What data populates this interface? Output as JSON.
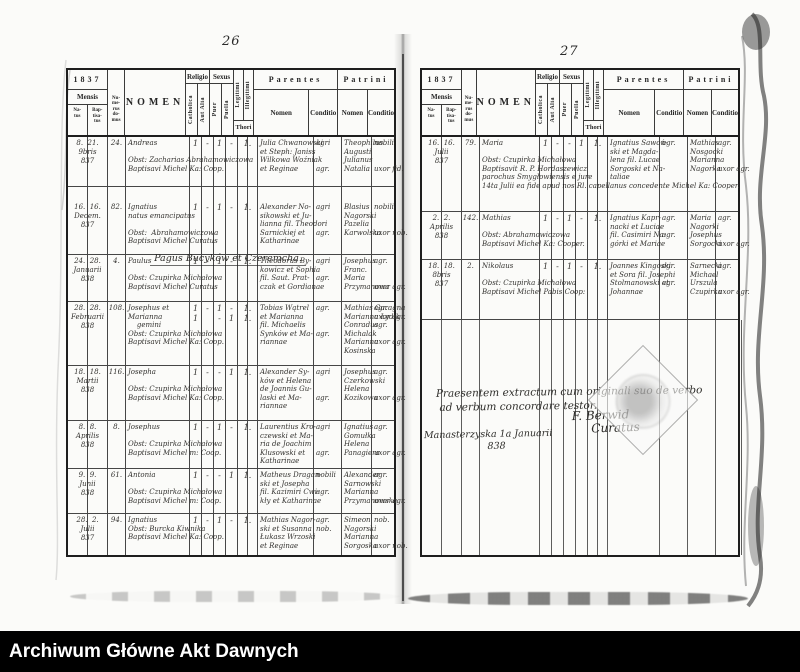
{
  "colors": {
    "paper": "#fbfbf9",
    "ink": "#262626",
    "bar_bg": "#000000",
    "bar_fg": "#ffffff"
  },
  "archive_bar": {
    "label": "Archiwum Główne Akt Dawnych"
  },
  "column_headers": {
    "year": "1837",
    "mensis": "Mensis",
    "natus": "Na-\ntus",
    "baptisatus": "Bap-\ntisa-\ntus",
    "numerus_domus": "Nu-\nme-\nrus\ndo-\nmus",
    "nomen": "NOMEN",
    "religio": "Religio",
    "catholica": "Catholica",
    "aut_alia": "Aut Alia",
    "sexus": "Sexus",
    "puer": "Puer",
    "puella": "Puella",
    "legitimi": "Legitimi",
    "illegitimi": "Illegitimi",
    "thori": "Thori",
    "parentes": "Parentes",
    "patrini": "Patrini",
    "parentes_nomen": "Nomen",
    "parentes_conditio": "Conditio",
    "patrini_nomen": "Nomen",
    "patrini_conditio": "Conditio"
  },
  "left_page": {
    "page_number": "26",
    "section_header": "Pagus Bucyków et Czeremcha.",
    "rows": [
      {
        "date": "8.  21.\n9bris\n837",
        "house": "24.",
        "name": "Andreas\n\nObst: Zacharias Abrahamowiczowa\nBaptisavi Michel Ka: Coop.",
        "marks": {
          "cath": "1",
          "alia": "-",
          "puer": "1",
          "puella": "-",
          "thori": "1."
        },
        "par_nomen": "Julia Chwanowski\net Steph: Janiss\nWilkowa Woźniak\net Reginae",
        "par_cond": "agri\n\n\nagr.",
        "pat_nomen": "Theophilus\nAugusti\nJulianus\nNatalia",
        "pat_cond": "nobili\n\n\nuxor fid."
      },
      {
        "date": "16.  16.\nDecem.\n837",
        "house": "82.",
        "name": "Ignatius\nnatus emancipatus\n\nObst:  Abrahamowiczowa\nBaptisavi Michel Curatus",
        "marks": {
          "cath": "1",
          "alia": "-",
          "puer": "1",
          "puella": "-",
          "thori": "1."
        },
        "par_nomen": "Alexander No-\nsikowski et Ju-\nlianna fil. Theodori\nSarnickiej et\nKatharinae",
        "par_cond": "agri\n\n\nagr.",
        "pat_nomen": "Blasius\nNagorski\nPazelia\nKarwolska",
        "pat_cond": "nobili\n\n\nuxor nob."
      },
      {
        "date": "24.  28.\nJanuarii\n838",
        "house": "4.",
        "name": "Paulus\n\nObst: Czupirka Michałowa\nBaptisavi Michel Curatus",
        "marks": {
          "cath": "1",
          "alia": "-",
          "puer": "1",
          "puella": "-",
          "thori": "1."
        },
        "par_nomen": "Theodorus By-\nkowicz et Sophia\nfil. Saut. Prat-\nczak et Gordianae",
        "par_cond": "agri\n\nagr.",
        "pat_nomen": "Josephus\nFranc.\nMaria\nPrzymanowa",
        "pat_cond": "agr.\n\n\nuxor agr."
      },
      {
        "date": "28.  28.\nFebruarii\n838",
        "house": "108.",
        "name": "Josephus et\nMarianna\n    gemini\nObst: Czupirka Michałowa\nBaptisavi Michel Ka: Coop.",
        "marks": {
          "cath": "1\n1",
          "alia": "-",
          "puer": "1\n-",
          "puella": "-\n1",
          "thori": "1.\n1."
        },
        "par_nomen": "Tobias Wątrel\net Marianna\nfil. Michaelis\nSynków et Ma-\nriannae",
        "par_cond": "agr.\n\n\nagr.",
        "pat_nomen": "Mathias Garagna\nMarianna Łydik\nConradus\nMichalak\nMarianna\nKosinska",
        "pat_cond": "agr.\nuxor agr.\nagr.\n\nuxor agr."
      },
      {
        "date": "18.  18.\nMartii\n838",
        "house": "116.",
        "name": "Josepha\n\nObst: Czupirka Michałowa\nBaptisavi Michel Ka: Coop.",
        "marks": {
          "cath": "1",
          "alia": "-",
          "puer": "-",
          "puella": "1",
          "thori": "1."
        },
        "par_nomen": "Alexander Sy-\nków et Helena\nde Joannis Gu-\nlaski et Ma-\nriannae",
        "par_cond": "agri\n\n\nagr.",
        "pat_nomen": "Josephus\nCzerkowski\nHelena\nKozikowa",
        "pat_cond": "agr.\n\n\nuxor agr."
      },
      {
        "date": "8.  8.\nAprilis\n838",
        "house": "8.",
        "name": "Josephus\n\nObst: Czupirka Michałowa\nBaptisavi Michel m: Coop.",
        "marks": {
          "cath": "1",
          "alia": "-",
          "puer": "1",
          "puella": "-",
          "thori": "1."
        },
        "par_nomen": "Laurentius Kro-\nczewski et Ma-\nria de Joachim\nKlusowski et\nKatharinae",
        "par_cond": "agri\n\n\nagr.",
        "pat_nomen": "Ignatius\nGomułka\nHelena\nPanagiera",
        "pat_cond": "agr.\n\n\nuxor agr."
      },
      {
        "date": "9.  9.\nJunii\n838",
        "house": "61.",
        "name": "Antonia\n\nObst: Czupirka Michałowa\nBaptisavi Michel m: Coop.",
        "marks": {
          "cath": "1",
          "alia": "-",
          "puer": "-",
          "puella": "1",
          "thori": "1."
        },
        "par_nomen": "Matheus Dragan-\nski et Josepha\nfil. Kazimiri Cwi-\nkły et Katharinae",
        "par_cond": "nobili\n\nagr.",
        "pat_nomen": "Alexander\nSarnowski\nMarianna\nPrzymanowska",
        "pat_cond": "agr.\n\n\nuxor agr."
      },
      {
        "date": "28.  2.\nJulii\n837",
        "house": "94.",
        "name": "Ignatius\nObst: Burcka Kiwnika\nBaptisavi Michel Ka: Coop.",
        "marks": {
          "cath": "1",
          "alia": "-",
          "puer": "1",
          "puella": "-",
          "thori": "1."
        },
        "par_nomen": "Mathias Nagor-\nski et Susanna\nŁukasz Wrzoski\net Reginae",
        "par_cond": "agr.\nnob.",
        "pat_nomen": "Simeon\nNagorski\nMarianna\nSorgoska",
        "pat_cond": "nob.\n\n\nuxor nob."
      }
    ]
  },
  "right_page": {
    "page_number": "27",
    "rows": [
      {
        "date": "16.  16.\nJulii\n837",
        "house": "79.",
        "name": "Maria\n\nObst: Czupirka Michałowa\nBaptisavit R. P. Hordaszewicz\nparochus Smygłowiensis e jure\n14ta Julii ea fide apud nos Rl. capellanus concedente Michel Ka: Cooper.",
        "marks": {
          "cath": "1",
          "alia": "-",
          "puer": "-",
          "puella": "1",
          "thori": "1."
        },
        "par_nomen": "Ignatius Sawoń-\nski et Magda-\nlena fil. Lucae\nSorgoski et Na-\ntaliae",
        "par_cond": "agr.",
        "pat_nomen": "Mathias\nNosgocki\nMarianna\nNagorka",
        "pat_cond": "agr.\n\n\nuxor agr."
      },
      {
        "date": "2.  2.\nAprilis\n838",
        "house": "142.",
        "name": "Mathias\n\nObst: Abrahamowiczowa\nBaptisavi Michel Ka: Cooper.",
        "marks": {
          "cath": "1",
          "alia": "-",
          "puer": "1",
          "puella": "-",
          "thori": "1."
        },
        "par_nomen": "Ignatius Kapr-\nnacki et Luciae\nfil. Casimiri Na-\ngórki et Mariae",
        "par_cond": "agr.\n\nagr.",
        "pat_nomen": "Maria\nNagorki\nJosephus\nSorgocki",
        "pat_cond": "agr.\n\n\nuxor agr."
      },
      {
        "date": "18.  18.\n8bris\n837",
        "house": "2.",
        "name": "Nikolaus\n\nObst: Czupirka Michałowa\nBaptisavi Michel Pabis Coop:",
        "marks": {
          "cath": "1",
          "alia": "-",
          "puer": "1",
          "puella": "-",
          "thori": "1."
        },
        "par_nomen": "Joannes Kingoski\net Sora fil. Josephi\nStolmanowski et\nJohannae",
        "par_cond": "agr.\n\nagr.",
        "pat_nomen": "Sarnecki\nMichael\nUrszula\nCzupirka",
        "pat_cond": "agr.\n\n\nuxor agr."
      }
    ],
    "certification": {
      "text": "Praesentem extractum cum originali suo de verbo\n ad verbum concordare testor.",
      "place_date": "Manasterzyska 1a Januarii\n                     838",
      "signature": "F. Berwid\n     Curatus"
    }
  }
}
